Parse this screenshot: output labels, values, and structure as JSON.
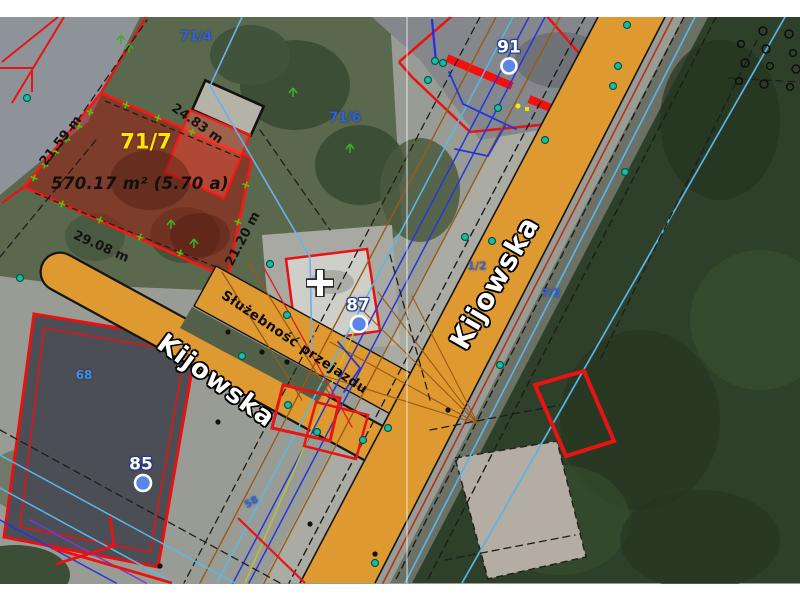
{
  "parcel": {
    "id": "71/7",
    "area": "570.17 m² (5.70 a)",
    "side_left": "21.59 m",
    "side_top": "24.83 m",
    "side_right": "21.20 m",
    "side_bottom": "29.08 m"
  },
  "labels": {
    "p71_4": "71/4",
    "p71_6": "71/6",
    "p1_2": "1/2",
    "p7_2": "7/2",
    "p68": "68",
    "p58": "58"
  },
  "markers": {
    "m91": "91",
    "m87": "87",
    "m85": "85"
  },
  "streets": {
    "main": "Kijowska",
    "side": "Kijowska"
  },
  "easement": {
    "label": "Służebność przejazdu"
  },
  "colors": {
    "road": "#DE9A30",
    "parcel-outline": "#FF1414",
    "parcel-fill": "rgba(160,22,12,0.52)",
    "parcel-inner-fill": "rgba(255,90,70,0.40)",
    "highlight-label": "#FFE800",
    "parcel-label-blue": "#2E62E0",
    "marker-fill": "#5B85E8",
    "survey-teal": "#18BCA2",
    "forest": "#2E4029",
    "grass": "#5A684E"
  }
}
